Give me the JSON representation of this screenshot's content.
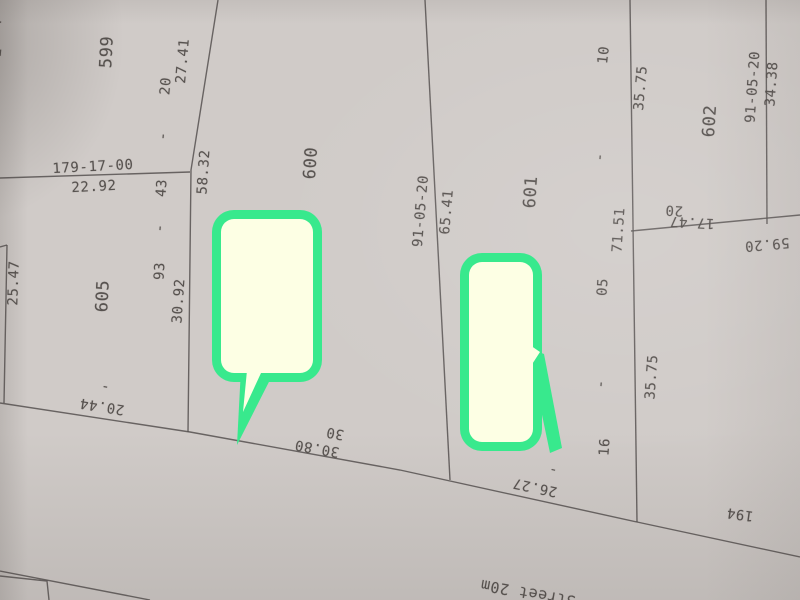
{
  "map": {
    "description": "cadastral survey plat photo with two green highlight callouts",
    "paper_color": "#d0cbc8",
    "line_color": "#565150",
    "text_color": "#4d4845",
    "highlight_border_color": "#38e98d",
    "highlight_fill_color": "#fdffe4",
    "street_label": "Street 20m",
    "survey_number_label": "179-17-00",
    "parcel_numbers": [
      "599",
      "600",
      "601",
      "602",
      "605",
      "194"
    ],
    "labels": [
      {
        "text": "599",
        "x": 107,
        "y": 52,
        "rot": -87,
        "size": 17,
        "kind": "parcel"
      },
      {
        "text": "600",
        "x": 311,
        "y": 163,
        "rot": -86,
        "size": 17,
        "kind": "parcel"
      },
      {
        "text": "601",
        "x": 531,
        "y": 192,
        "rot": -86,
        "size": 17,
        "kind": "parcel"
      },
      {
        "text": "602",
        "x": 710,
        "y": 121,
        "rot": -86,
        "size": 17,
        "kind": "parcel"
      },
      {
        "text": "605",
        "x": 103,
        "y": 296,
        "rot": -87,
        "size": 17,
        "kind": "parcel"
      },
      {
        "text": "194",
        "x": 740,
        "y": 514,
        "rot": 188,
        "size": 14,
        "kind": "parcel"
      },
      {
        "text": "179-17-00",
        "x": 93,
        "y": 167,
        "rot": -3,
        "size": 14,
        "kind": "measure"
      },
      {
        "text": "22.92",
        "x": 94,
        "y": 187,
        "rot": -3,
        "size": 14,
        "kind": "measure"
      },
      {
        "text": "27.41",
        "x": 183,
        "y": 61,
        "rot": -85,
        "size": 14,
        "kind": "measure"
      },
      {
        "text": "20",
        "x": 166,
        "y": 86,
        "rot": -85,
        "size": 14,
        "kind": "measure"
      },
      {
        "text": "-",
        "x": 163,
        "y": 136,
        "rot": -85,
        "size": 14,
        "kind": "measure"
      },
      {
        "text": "58.32",
        "x": 204,
        "y": 172,
        "rot": -86,
        "size": 14,
        "kind": "measure"
      },
      {
        "text": "43",
        "x": 162,
        "y": 188,
        "rot": -86,
        "size": 14,
        "kind": "measure"
      },
      {
        "text": "-",
        "x": 160,
        "y": 228,
        "rot": -86,
        "size": 14,
        "kind": "measure"
      },
      {
        "text": "93",
        "x": 160,
        "y": 271,
        "rot": -87,
        "size": 14,
        "kind": "measure"
      },
      {
        "text": "30.92",
        "x": 179,
        "y": 301,
        "rot": -86,
        "size": 14,
        "kind": "measure"
      },
      {
        "text": "25.47",
        "x": 14,
        "y": 283,
        "rot": -88,
        "size": 14,
        "kind": "measure"
      },
      {
        "text": "91-05-20",
        "x": 421,
        "y": 211,
        "rot": -85,
        "size": 14,
        "kind": "measure"
      },
      {
        "text": "65.41",
        "x": 447,
        "y": 212,
        "rot": -85,
        "size": 14,
        "kind": "measure"
      },
      {
        "text": "10",
        "x": 604,
        "y": 55,
        "rot": -84,
        "size": 14,
        "kind": "measure"
      },
      {
        "text": "-",
        "x": 600,
        "y": 157,
        "rot": -86,
        "size": 14,
        "kind": "measure"
      },
      {
        "text": "35.75",
        "x": 641,
        "y": 88,
        "rot": -85,
        "size": 14,
        "kind": "measure"
      },
      {
        "text": "91-05-20",
        "x": 753,
        "y": 87,
        "rot": -86,
        "size": 14,
        "kind": "measure"
      },
      {
        "text": "34.38",
        "x": 772,
        "y": 84,
        "rot": -86,
        "size": 14,
        "kind": "measure"
      },
      {
        "text": "71.51",
        "x": 619,
        "y": 230,
        "rot": -86,
        "size": 14,
        "kind": "measure"
      },
      {
        "text": "05",
        "x": 603,
        "y": 287,
        "rot": -86,
        "size": 14,
        "kind": "measure"
      },
      {
        "text": "-",
        "x": 601,
        "y": 384,
        "rot": -86,
        "size": 14,
        "kind": "measure"
      },
      {
        "text": "35.75",
        "x": 652,
        "y": 377,
        "rot": -86,
        "size": 14,
        "kind": "measure"
      },
      {
        "text": "16",
        "x": 605,
        "y": 447,
        "rot": -86,
        "size": 14,
        "kind": "measure"
      },
      {
        "text": "20",
        "x": 674,
        "y": 210,
        "rot": 183,
        "size": 14,
        "kind": "measure"
      },
      {
        "text": "17.47",
        "x": 692,
        "y": 222,
        "rot": 183,
        "size": 14,
        "kind": "measure"
      },
      {
        "text": "59.20",
        "x": 767,
        "y": 244,
        "rot": 175,
        "size": 14,
        "kind": "measure"
      },
      {
        "text": "20.44",
        "x": 102,
        "y": 406,
        "rot": 189,
        "size": 14,
        "kind": "measure"
      },
      {
        "text": "-",
        "x": 105,
        "y": 387,
        "rot": 189,
        "size": 14,
        "kind": "measure"
      },
      {
        "text": "30",
        "x": 335,
        "y": 433,
        "rot": 190,
        "size": 14,
        "kind": "measure"
      },
      {
        "text": "30.80",
        "x": 317,
        "y": 448,
        "rot": 190,
        "size": 14,
        "kind": "measure"
      },
      {
        "text": "-",
        "x": 553,
        "y": 470,
        "rot": 192,
        "size": 14,
        "kind": "measure"
      },
      {
        "text": "26.27",
        "x": 535,
        "y": 487,
        "rot": 192,
        "size": 14,
        "kind": "measure"
      },
      {
        "text": "Street 20m",
        "x": 528,
        "y": 593,
        "rot": 190,
        "size": 15,
        "kind": "road"
      },
      {
        "text": "4",
        "x": -3,
        "y": 23,
        "rot": -85,
        "size": 14,
        "kind": "edge-fragment"
      },
      {
        "text": "2",
        "x": -3,
        "y": 52,
        "rot": -85,
        "size": 14,
        "kind": "edge-fragment"
      }
    ],
    "lines": [
      {
        "points": [
          [
            0,
            178
          ],
          [
            190,
            172
          ]
        ]
      },
      {
        "points": [
          [
            218,
            0
          ],
          [
            191,
            170
          ],
          [
            188,
            432
          ]
        ]
      },
      {
        "points": [
          [
            425,
            0
          ],
          [
            450,
            480
          ]
        ]
      },
      {
        "points": [
          [
            630,
            0
          ],
          [
            637,
            522
          ]
        ]
      },
      {
        "points": [
          [
            766,
            0
          ],
          [
            767,
            224
          ]
        ]
      },
      {
        "points": [
          [
            631,
            231
          ],
          [
            800,
            215
          ]
        ]
      },
      {
        "points": [
          [
            0,
            403
          ],
          [
            190,
            432
          ],
          [
            400,
            470
          ],
          [
            637,
            522
          ],
          [
            800,
            557
          ]
        ]
      },
      {
        "points": [
          [
            0,
            571
          ],
          [
            150,
            600
          ]
        ]
      },
      {
        "points": [
          [
            0,
            576
          ],
          [
            47,
            581
          ],
          [
            49,
            600
          ]
        ]
      },
      {
        "points": [
          [
            7,
            245
          ],
          [
            4,
            403
          ]
        ]
      },
      {
        "points": [
          [
            0,
            247
          ],
          [
            7,
            245
          ]
        ]
      }
    ],
    "callouts": [
      {
        "name": "highlight-callout-1",
        "x": 212,
        "y": 210,
        "w": 110,
        "h": 172,
        "r": 22,
        "border": 9,
        "tail": [
          [
            241,
            368
          ],
          [
            276,
            368
          ],
          [
            237,
            445
          ]
        ],
        "tail_inner": [
          [
            248,
            360
          ],
          [
            267,
            360
          ],
          [
            243,
            412
          ]
        ]
      },
      {
        "name": "highlight-callout-2",
        "x": 460,
        "y": 253,
        "w": 82,
        "h": 198,
        "r": 22,
        "border": 9,
        "tail": [
          [
            528,
            348
          ],
          [
            544,
            354
          ],
          [
            562,
            448
          ],
          [
            550,
            453
          ]
        ],
        "tail_inner": [
          [
            524,
            341
          ],
          [
            540,
            352
          ],
          [
            527,
            372
          ]
        ]
      }
    ]
  }
}
